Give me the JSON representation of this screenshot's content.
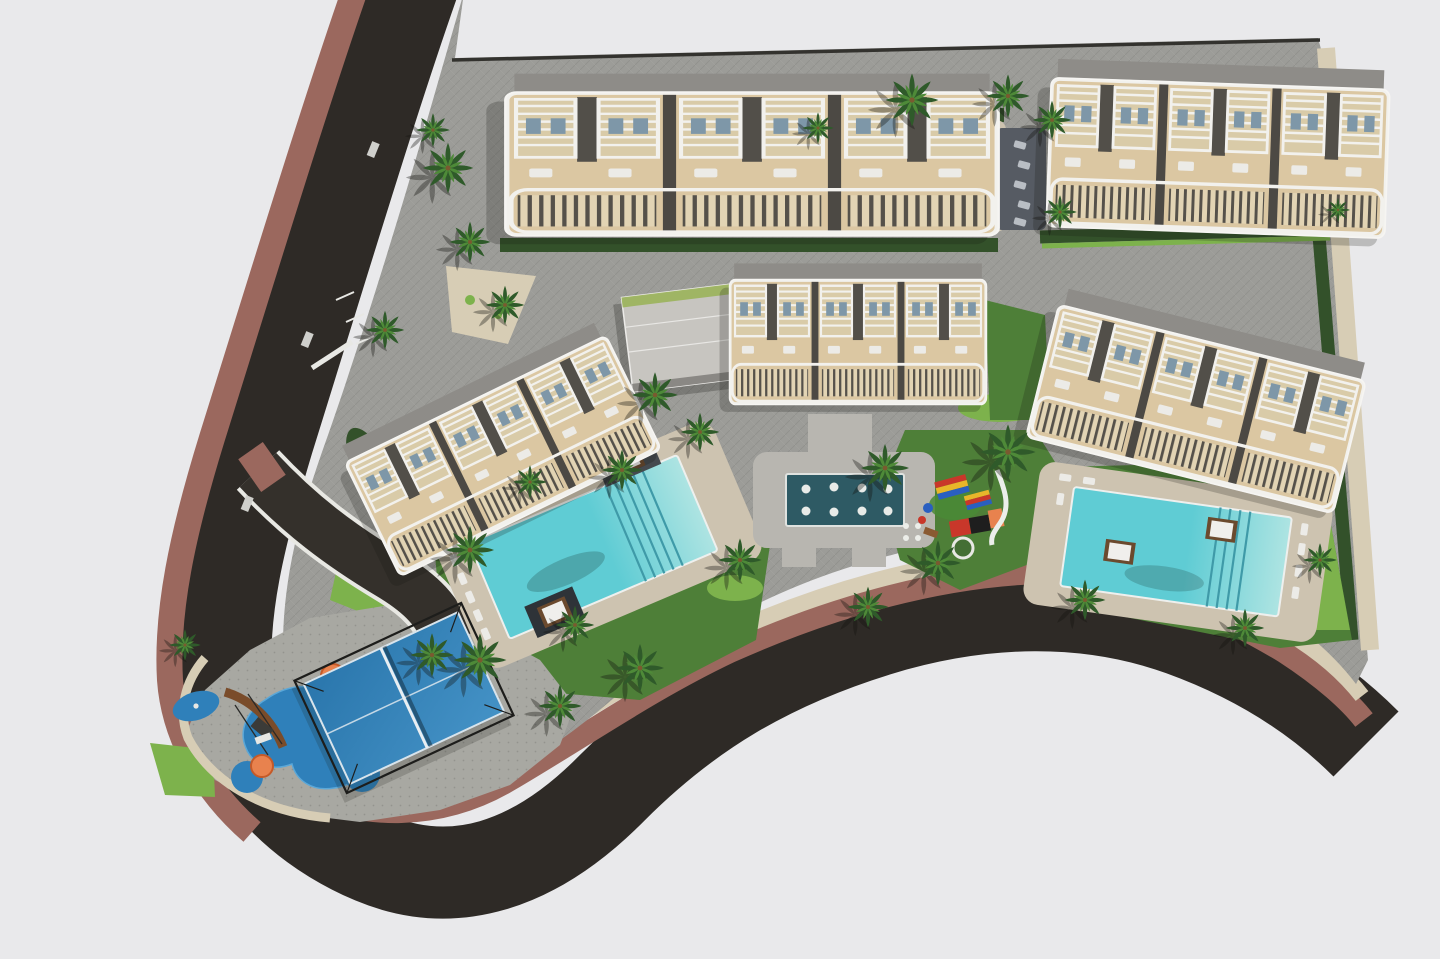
{
  "scene": {
    "description": "Aerial 3D architectural rendering of a residential complex masterplan: five beige apartment blocks with white pergola roof terraces, three turquoise swimming pools with sun decks, a dark reflective fountain pool, a paddle tennis court, two playgrounds, lawns and palm trees, bounded by a dark asphalt road with a terracotta sidewalk that wraps the left and bottom edges.",
    "areas": [
      "perimeter road",
      "terracotta sidewalk",
      "gravel border",
      "top apartment row",
      "north shared pool",
      "middle apartment row",
      "communal building",
      "southwest pool",
      "southeast pool",
      "central fountain pool",
      "central playground",
      "southwest playground",
      "paddle tennis court",
      "internal driveway",
      "paved plaza",
      "lawns and palm trees"
    ],
    "counts": {
      "apartment_blocks": 5,
      "communal_buildings": 1,
      "swimming_pools": 3,
      "fountain_pools": 1,
      "paddle_courts": 1,
      "playgrounds": 2,
      "palm_trees_approx": 30
    }
  },
  "colors": {
    "background": "#e9e9eb",
    "road": "#2e2a26",
    "driveway": "#34302b",
    "sidewalk_brown": "#9b685e",
    "gravel": "#d7cdb5",
    "paver_gray": "#9c9c98",
    "paver_light": "#a8a8a2",
    "deck_beige": "#cdc3b0",
    "deck_dark": "#565b63",
    "building_beige": "#dbc7a2",
    "building_roof": "#8e8c88",
    "terrace_beige": "#e2d4b4",
    "grass": "#4e7f38",
    "grass_bright": "#7db24c",
    "hedge_dark": "#33512a",
    "palm_green": "#2f5a2a",
    "palm_green_light": "#4e8a38",
    "pool_water": "#5fccd4",
    "pool_light": "#aee4e2",
    "pool_step": "#3f9aa8",
    "fountain_water": "#2e5a64",
    "court_blue": "#2a76ac",
    "court_blue_light": "#4492c6",
    "rubber_blue": "#2f80ba",
    "play_red": "#c9372a",
    "play_yellow": "#e8b62a",
    "play_blue": "#2a5fc0",
    "play_orange": "#e8824e",
    "wood_brown": "#7a4c2a",
    "daybed_brown": "#6b4a2e",
    "white": "#f2f1ed",
    "lounger_gray": "#b9bec4",
    "fence_dark": "#33322e"
  }
}
